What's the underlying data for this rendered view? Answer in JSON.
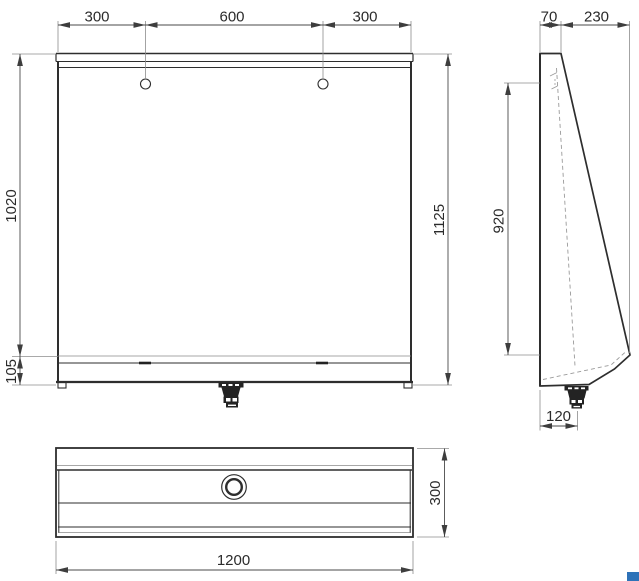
{
  "drawing": {
    "title": "Dimensioned technical drawing of a wall-mounted stainless trough urinal (front, side and plan views)",
    "dimensions": {
      "front": {
        "hole_offset_left": "300",
        "hole_spacing": "600",
        "hole_offset_right": "300",
        "panel_height": "1020",
        "skirt_height": "105",
        "total_height": "1125"
      },
      "side": {
        "top_depth": "70",
        "slope_depth": "230",
        "basin_height": "920",
        "drain_offset": "120"
      },
      "plan": {
        "width": "1200",
        "depth": "300"
      }
    },
    "colors": {
      "line": "#2e2e2e",
      "dimension_line": "#4a4a4a",
      "text": "#2b2b2b",
      "accent_blue": "#2e72b8",
      "background": "#ffffff"
    }
  }
}
